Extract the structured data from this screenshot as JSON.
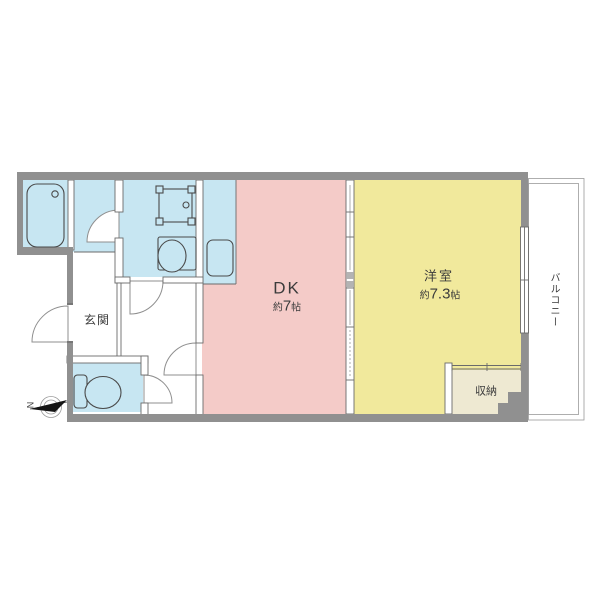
{
  "floor_plan": {
    "rooms": {
      "dk": {
        "label": "DK",
        "size_prefix": "約",
        "size_value": "7",
        "size_unit": "帖"
      },
      "bedroom": {
        "label": "洋室",
        "size_prefix": "約",
        "size_value": "7.3",
        "size_unit": "帖"
      },
      "genkan": {
        "label": "玄関"
      },
      "storage": {
        "label": "収納"
      },
      "balcony": {
        "label": "バルコニー"
      }
    },
    "compass": {
      "label": "N"
    },
    "colors": {
      "wet_area_blue": "#c7e6f2",
      "dk_pink": "#f4cbc8",
      "bedroom_yellow": "#f1e99c",
      "storage_cream": "#eee9d2",
      "wall_gray": "#909090"
    }
  }
}
